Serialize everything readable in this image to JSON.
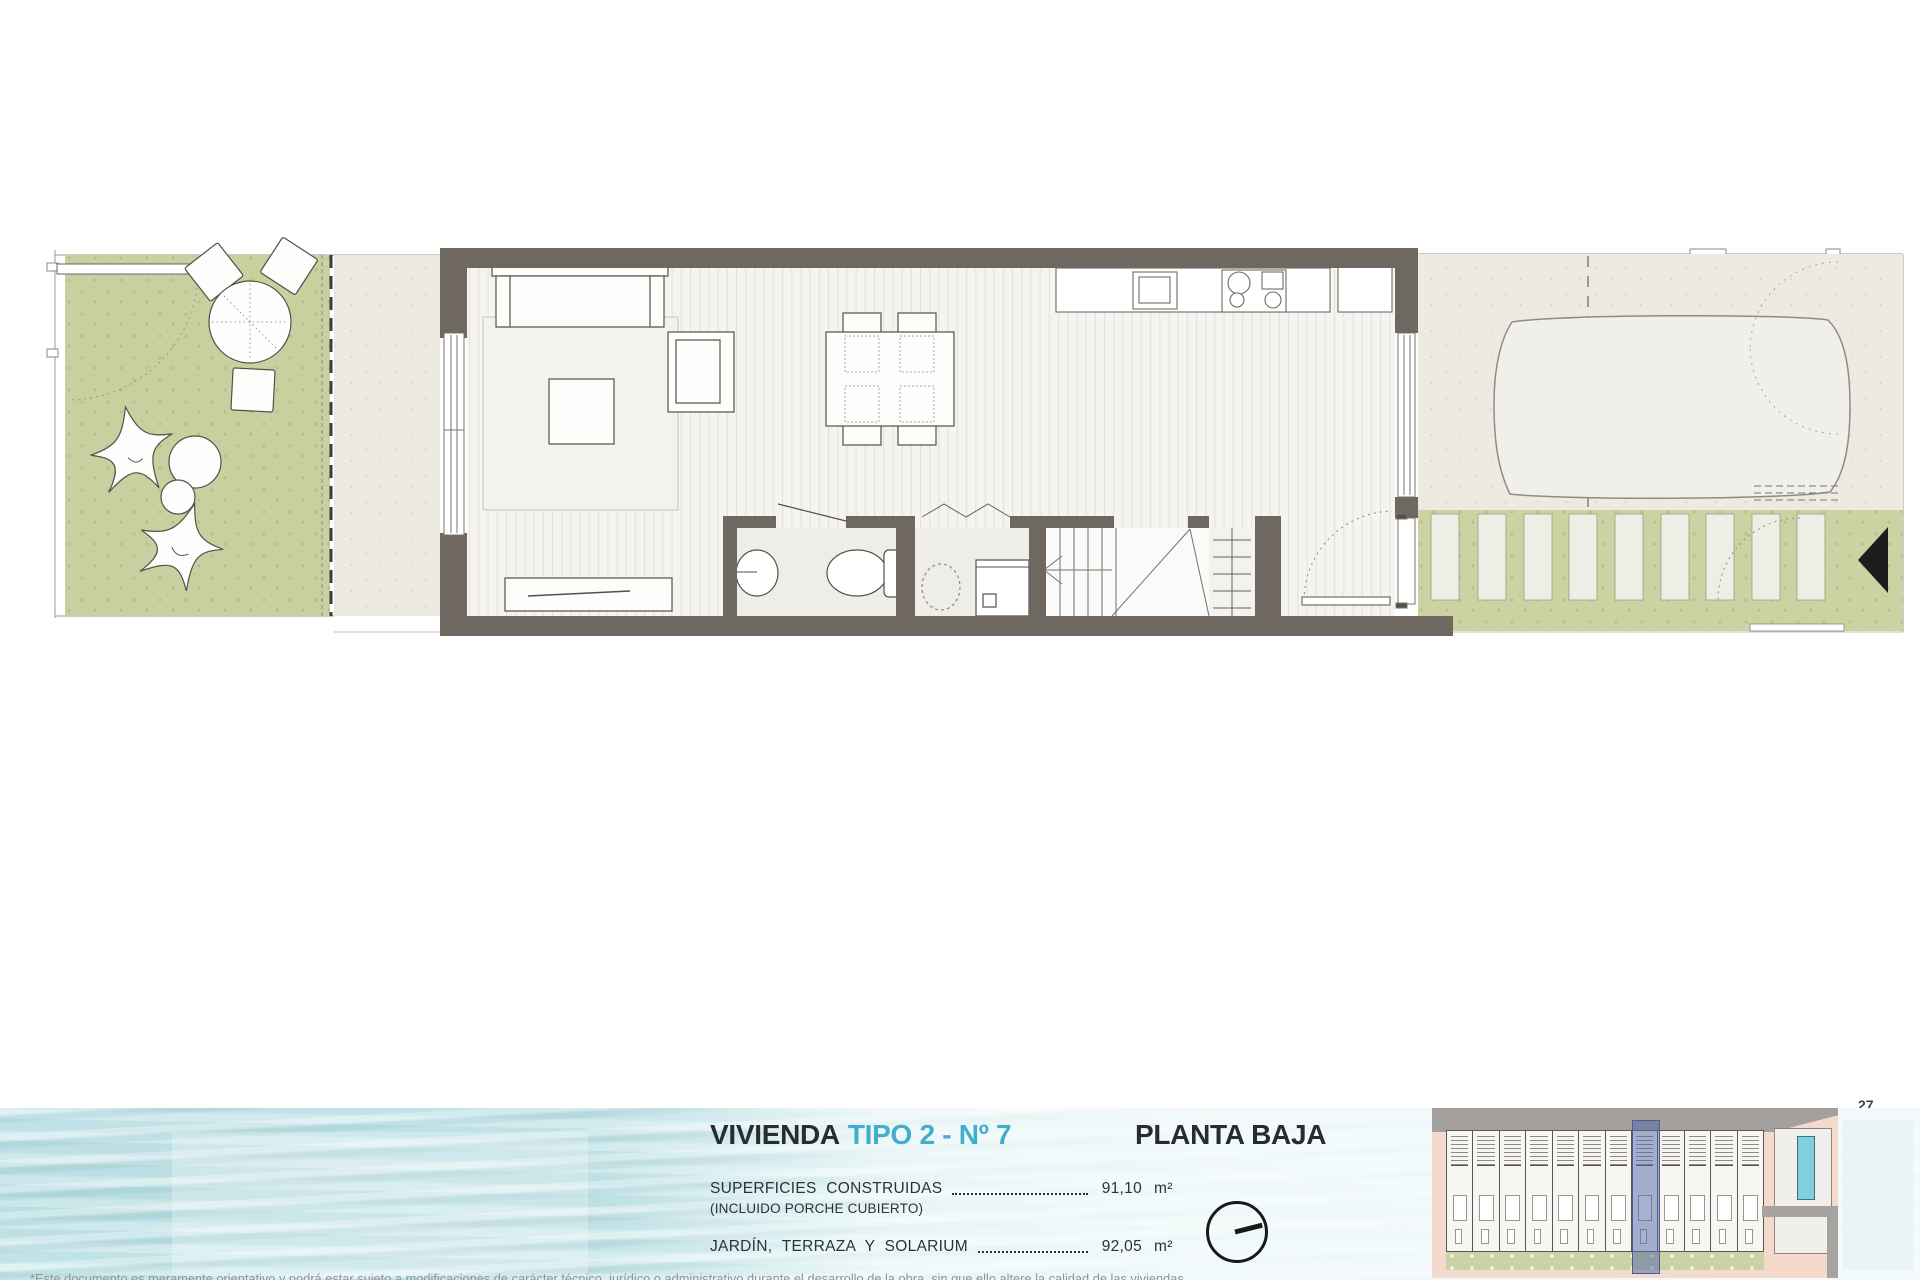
{
  "footer": {
    "title": {
      "black": "VIVIENDA",
      "accent": "TIPO 2 - Nº 7"
    },
    "plan_label": "PLANTA BAJA",
    "areas": [
      {
        "label": "SUPERFICIES CONSTRUIDAS",
        "sublabel": "(INCLUIDO PORCHE CUBIERTO)",
        "value": "91,10",
        "unit": "m²"
      },
      {
        "label": "JARDÍN, TERRAZA Y SOLARIUM",
        "sublabel": "",
        "value": "92,05",
        "unit": "m²"
      }
    ],
    "compass_icon": "north-arrow",
    "siteplan": {
      "columns": 12,
      "highlight_column": 8,
      "highlight_unit": "Nº 7"
    }
  },
  "page": {
    "page_number": "27",
    "disclaimer": "*Este documento es meramente orientativo y podrá estar sujeto a modificaciones de carácter técnico, jurídico o administrativo durante el desarrollo de la obra, sin que ello altere la calidad de las viviendas."
  },
  "colors": {
    "accent_cyan": "#41aecb",
    "wall": "#6e6860",
    "garden_green": "#c9cf9f",
    "driveway_green": "#ccd2a2",
    "porch_beige": "#ebe9e0",
    "terrace_beige": "#edebe1",
    "floor": "#f5f4f0",
    "water_blue": "#c2e3e7",
    "siteplan_pink": "#f3dacc",
    "highlight_blue": "#5e6dae",
    "pool_cyan": "#7ed0dc",
    "road_gray": "#a3a09d"
  }
}
